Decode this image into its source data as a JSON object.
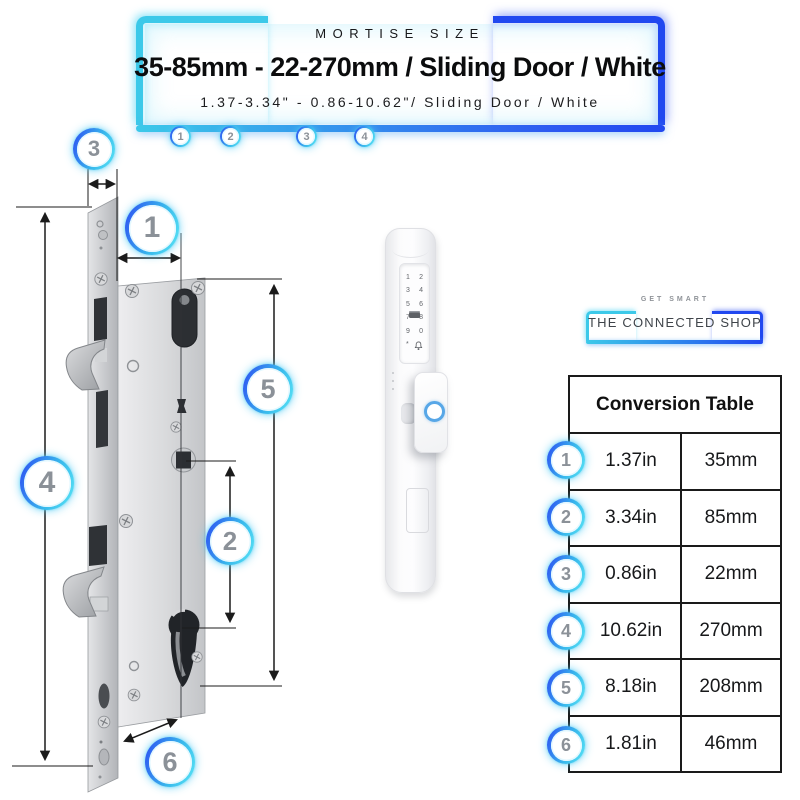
{
  "banner": {
    "eyebrow": "MORTISE SIZE",
    "title": "35-85mm - 22-270mm / Sliding Door / White",
    "subtitle": "1.37-3.34\" - 0.86-10.62\"/ Sliding Door / White",
    "markers": [
      "1",
      "2",
      "3",
      "4"
    ]
  },
  "diagram": {
    "callouts": [
      {
        "label": "3"
      },
      {
        "label": "1"
      },
      {
        "label": "5"
      },
      {
        "label": "4"
      },
      {
        "label": "2"
      },
      {
        "label": "6"
      }
    ]
  },
  "device": {
    "keypad_rows": [
      [
        "1",
        "2"
      ],
      [
        "3",
        "4"
      ],
      [
        "5",
        "6"
      ],
      [
        "7",
        "8"
      ],
      [
        "9",
        "0"
      ]
    ],
    "star_key": "*",
    "icons": [
      "keycard-icon",
      "doorbell-icon",
      "fingerprint-ring"
    ]
  },
  "logo": {
    "tagline": "GET SMART",
    "name": "THE CONNECTED SHOP"
  },
  "conversion_table": {
    "title": "Conversion Table",
    "rows": [
      {
        "num": "1",
        "inches": "1.37in",
        "mm": "35mm"
      },
      {
        "num": "2",
        "inches": "3.34in",
        "mm": "85mm"
      },
      {
        "num": "3",
        "inches": "0.86in",
        "mm": "22mm"
      },
      {
        "num": "4",
        "inches": "10.62in",
        "mm": "270mm"
      },
      {
        "num": "5",
        "inches": "8.18in",
        "mm": "208mm"
      },
      {
        "num": "6",
        "inches": "1.81in",
        "mm": "46mm"
      }
    ]
  },
  "colors": {
    "cyan": "#3cc9e9",
    "blue": "#2148f0",
    "badge_number": "#8b9198",
    "table_border": "#1a1a1a",
    "fingerprint_ring": "#58a7e7"
  }
}
